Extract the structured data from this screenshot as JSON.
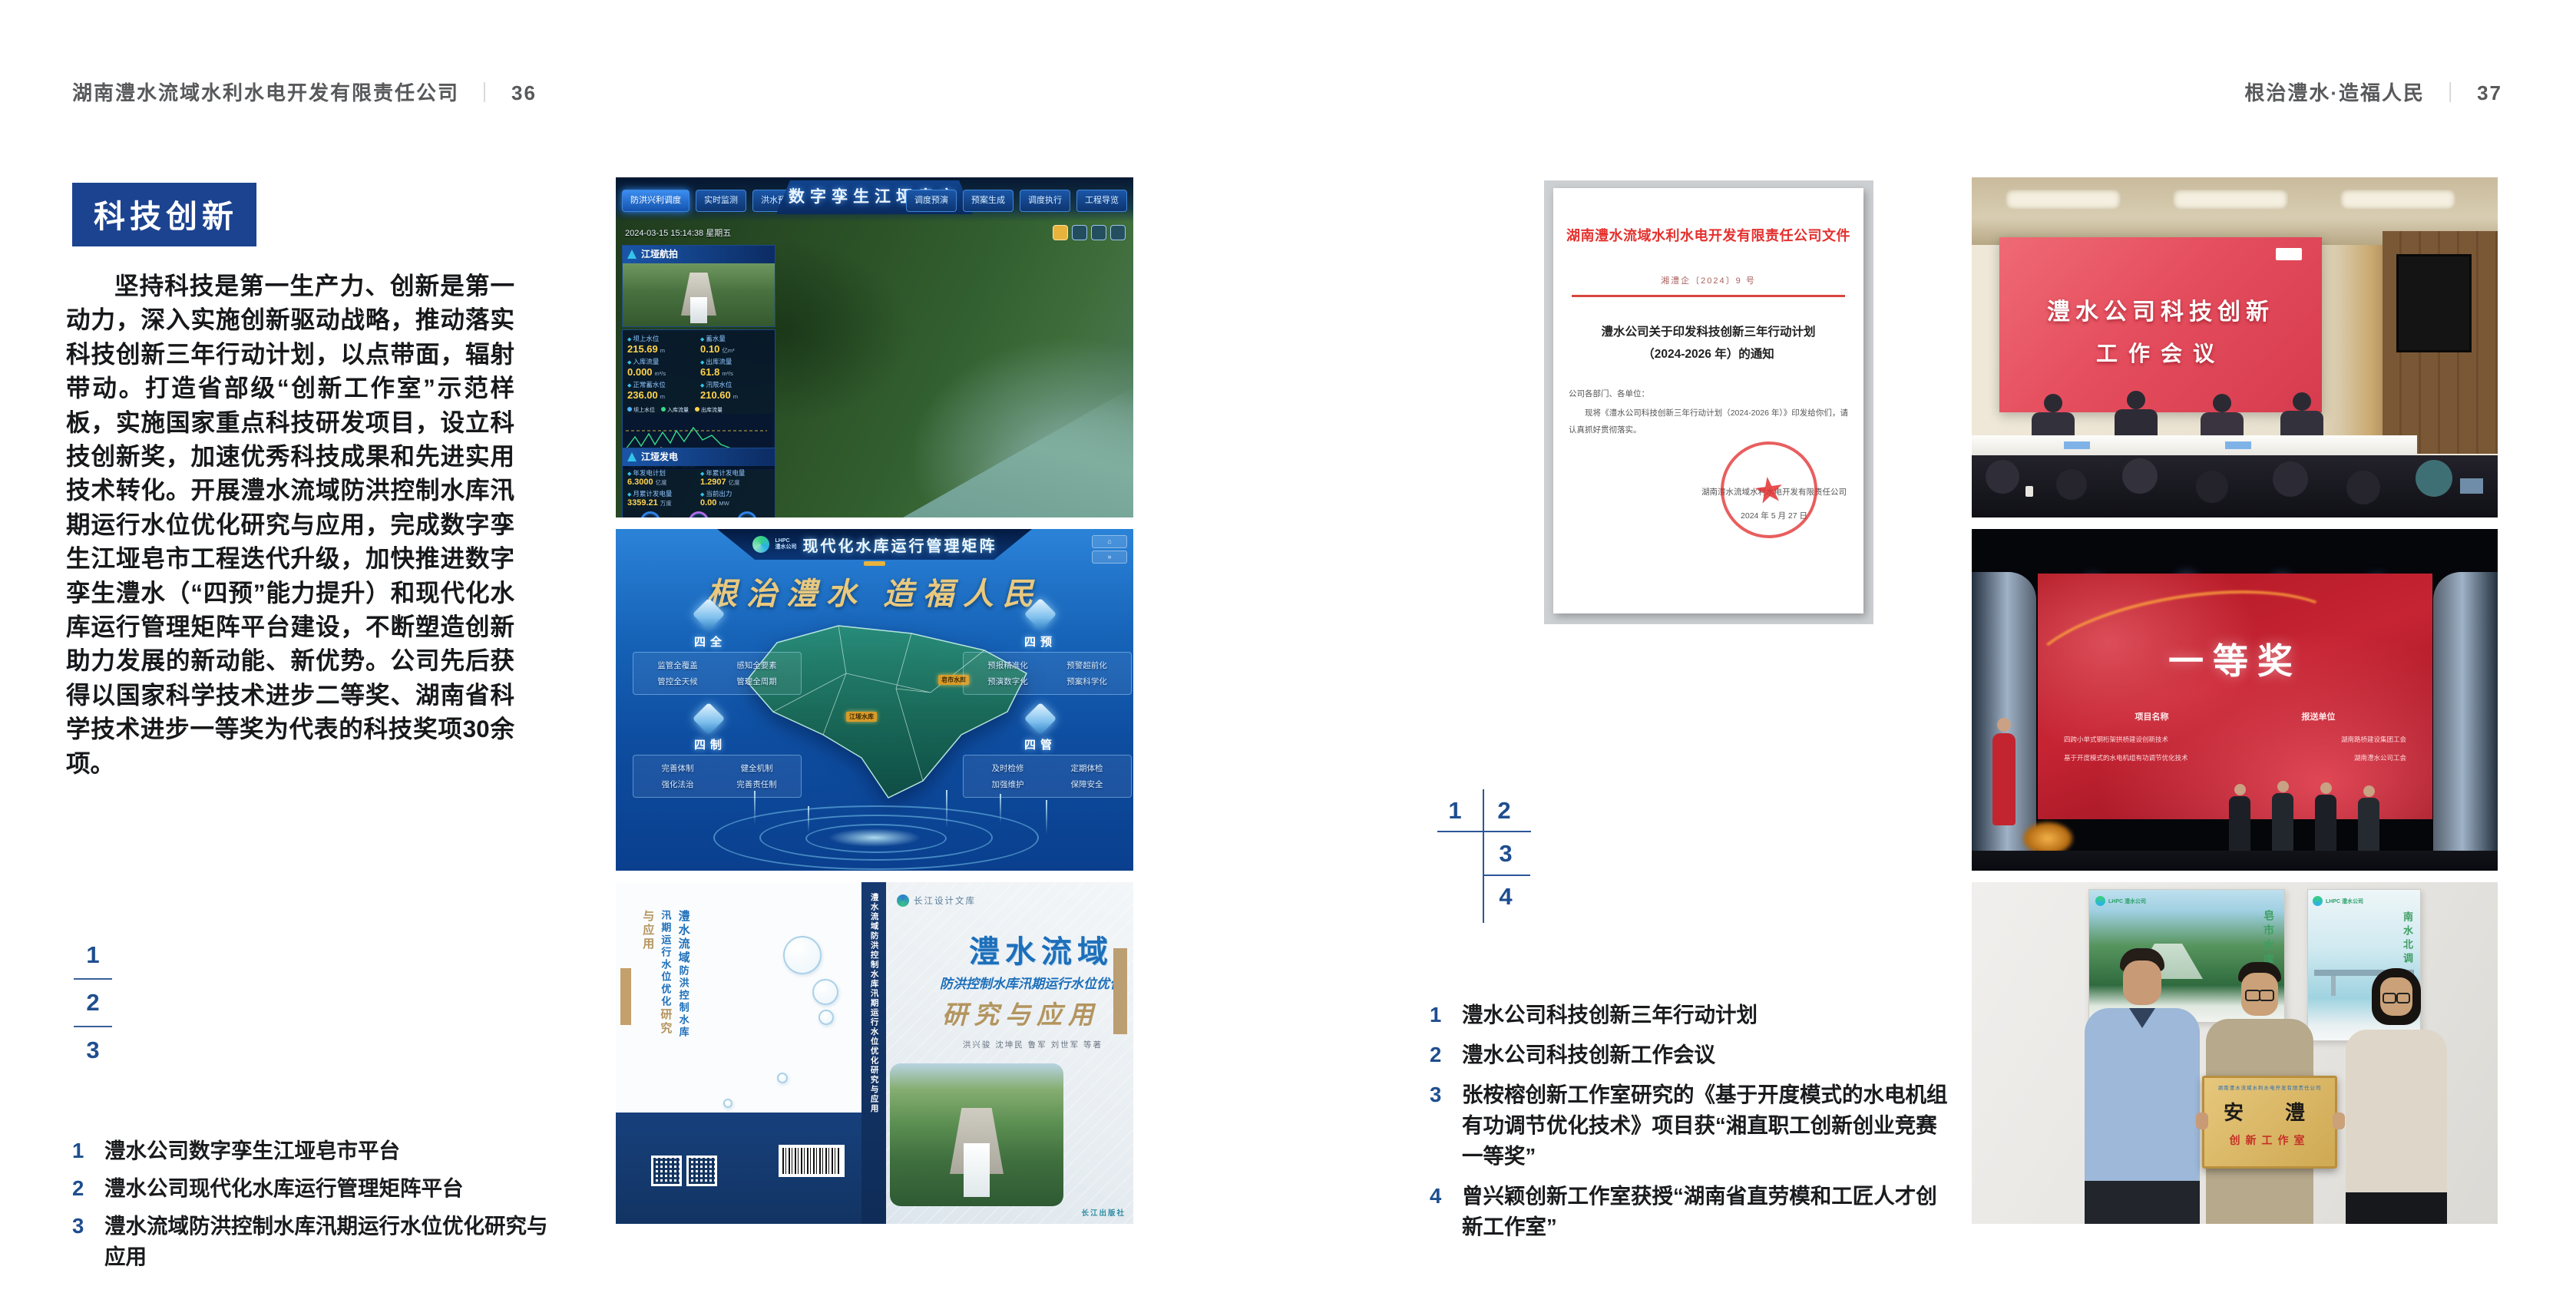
{
  "colors": {
    "accent_blue": "#1c4390",
    "index_blue": "#1f4e8f",
    "doc_red": "#e3312e"
  },
  "left_page": {
    "header_title": "湖南澧水流域水利水电开发有限责任公司",
    "header_sep": "｜",
    "page_number": "36",
    "badge": "科技创新",
    "paragraph": "坚持科技是第一生产力、创新是第一动力，深入实施创新驱动战略，推动落实科技创新三年行动计划，以点带面，辐射带动。打造省部级“创新工作室”示范样板，实施国家重点科技研发项目，设立科技创新奖，加速优秀科技成果和先进实用技术转化。开展澧水流域防洪控制水库汛期运行水位优化研究与应用，完成数字孪生江垭皂市工程迭代升级，加快推进数字孪生澧水（“四预”能力提升）和现代化水库运行管理矩阵平台建设，不断塑造创新助力发展的新动能、新优势。公司先后获得以国家科学技术进步二等奖、湖南省科学技术进步一等奖为代表的科技奖项30余项。",
    "figure_index": {
      "n1": "1",
      "n2": "2",
      "n3": "3"
    },
    "captions": [
      {
        "num": "1",
        "text": "澧水公司数字孪生江垭皂市平台"
      },
      {
        "num": "2",
        "text": "澧水公司现代化水库运行管理矩阵平台"
      },
      {
        "num": "3",
        "text": "澧水流域防洪控制水库汛期运行水位优化研究与应用"
      }
    ]
  },
  "right_page": {
    "header_title": "根治澧水·造福人民",
    "header_sep": "｜",
    "page_number": "37",
    "figure_index": {
      "n1": "1",
      "n2": "2",
      "n3": "3",
      "n4": "4"
    },
    "captions": [
      {
        "num": "1",
        "text": "澧水公司科技创新三年行动计划"
      },
      {
        "num": "2",
        "text": "澧水公司科技创新工作会议"
      },
      {
        "num": "3",
        "text": "张桉榕创新工作室研究的《基于开度模式的水电机组有功调节优化技术》项目获“湘直职工创新创业竞赛一等奖”"
      },
      {
        "num": "4",
        "text": "曾兴颖创新工作室获授“湖南省直劳模和工匠人才创新工作室”"
      }
    ]
  },
  "fig_twin": {
    "title": "数字孪生江垭皂市",
    "tabs_left": [
      "防洪兴利调度",
      "实时监测",
      "洪水预报",
      "防洪预警"
    ],
    "tabs_right": [
      "调度预演",
      "预案生成",
      "调度执行",
      "工程导览"
    ],
    "timestamp": "2024-03-15 15:14:38 星期五",
    "video_label": "江垭航拍",
    "metrics": [
      {
        "label": "坝上水位",
        "value": "215.69",
        "unit": "m"
      },
      {
        "label": "蓄水量",
        "value": "0.10",
        "unit": "亿m³"
      },
      {
        "label": "入库流量",
        "value": "0.000",
        "unit": "m³/s"
      },
      {
        "label": "出库流量",
        "value": "61.8",
        "unit": "m³/s"
      },
      {
        "label": "正常蓄水位",
        "value": "236.00",
        "unit": "m"
      },
      {
        "label": "汛限水位",
        "value": "210.60",
        "unit": "m"
      }
    ],
    "chart_legend": [
      "坝上水位",
      "入库流量",
      "出库流量"
    ],
    "chart_x": "03-12　03-13　03-13　03-14",
    "gen_title": "江垭发电",
    "gen_metrics": [
      {
        "label": "年发电计划",
        "value": "6.3000",
        "unit": "亿度"
      },
      {
        "label": "年累计发电量",
        "value": "1.2907",
        "unit": "亿度"
      },
      {
        "label": "月累计发电量",
        "value": "3359.21",
        "unit": "万度"
      },
      {
        "label": "当前出力",
        "value": "0.00",
        "unit": "MW"
      }
    ],
    "gauges": [
      {
        "value": "0.00",
        "label": "1号机组"
      },
      {
        "value": "100.98",
        "label": "2号机组"
      },
      {
        "value": "0.00",
        "label": "3号机组"
      }
    ]
  },
  "fig_matrix": {
    "logo_line1": "LHPC",
    "logo_line2": "澧水公司",
    "title": "现代化水库运行管理矩阵",
    "slogan": "根治澧水 造福人民",
    "panels": [
      {
        "name": "四全",
        "items": [
          "监管全覆盖",
          "感知全要素",
          "管控全天候",
          "管理全周期"
        ]
      },
      {
        "name": "四预",
        "items": [
          "预报精准化",
          "预警超前化",
          "预演数字化",
          "预案科学化"
        ]
      },
      {
        "name": "四制",
        "items": [
          "完善体制",
          "健全机制",
          "强化法治",
          "完善责任制"
        ]
      },
      {
        "name": "四管",
        "items": [
          "及时检修",
          "定期体检",
          "加强维护",
          "保障安全"
        ]
      }
    ],
    "map_labels": [
      "江垭水库",
      "皂市水库"
    ]
  },
  "fig_book": {
    "brand": "长江设计文库",
    "title_main": "澧水流域",
    "title_sub": "防洪控制水库汛期运行水位优化",
    "title_tail": "研究与应用",
    "authors": "洪兴骏 沈坤民 鲁军 刘世军 等著",
    "spine": "澧水流域防洪控制水库汛期运行水位优化研究与应用",
    "publisher": "长江出版社",
    "back_v1": "澧水流域",
    "back_v2": "防洪控制水库汛期运行水位优化",
    "back_v3": "研究与应用"
  },
  "fig_doc": {
    "letterhead": "湖南澧水流域水利水电开发有限责任公司文件",
    "doc_no": "湘澧企〔2024〕9 号",
    "title_l1": "澧水公司关于印发科技创新三年行动计划",
    "title_l2": "（2024-2026 年）的通知",
    "salutation": "公司各部门、各单位：",
    "body": "现将《澧水公司科技创新三年行动计划（2024-2026 年）》印发给你们，请认真抓好贯彻落实。",
    "signer": "湖南澧水流域水利水电开发有限责任公司",
    "date": "2024 年 5 月 27 日"
  },
  "fig_meeting": {
    "screen_line1": "澧水公司科技创新",
    "screen_line2": "工作会议"
  },
  "fig_award": {
    "title": "一等奖",
    "col_project": "项目名称",
    "col_unit": "报送单位",
    "rows": [
      {
        "project": "四跨小单式钢桁架拱桥建设创新技术",
        "unit": "湖南路桥建设集团工会"
      },
      {
        "project": "基于开度模式的水电机组有功调节优化技术",
        "unit": "湖南澧水公司工会"
      }
    ]
  },
  "fig_plaque": {
    "board_top": "湖南澧水流域水利水电开发有限责任公司",
    "board_main": "安　澧",
    "board_sub": "创新工作室",
    "poster_left_v": "皂市水库",
    "poster_right_v": "南水北调",
    "poster_logo": "LHPC 澧水公司"
  }
}
